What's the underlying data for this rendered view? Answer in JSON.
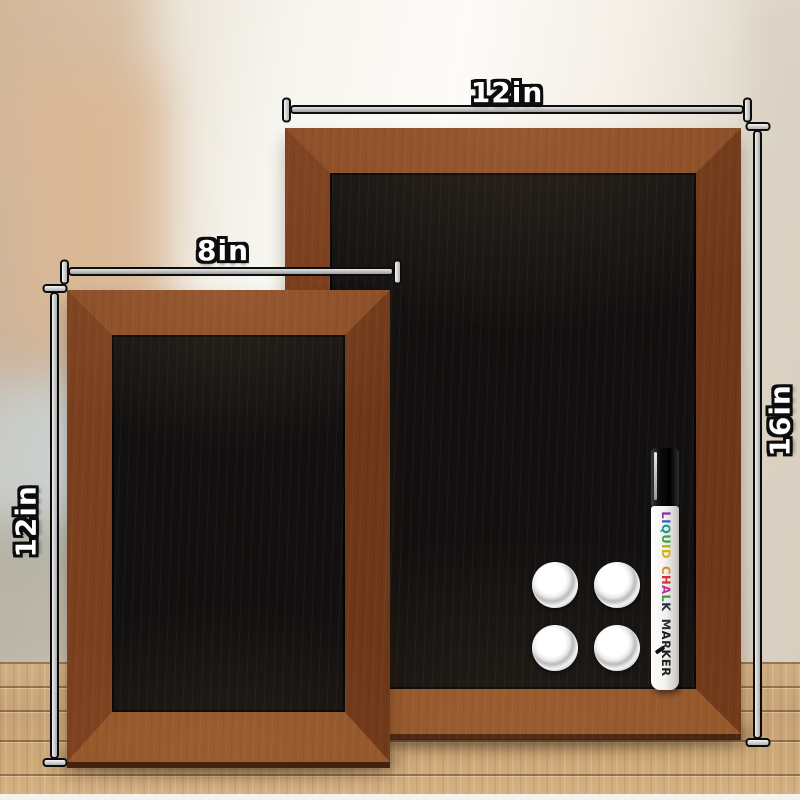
{
  "labels": {
    "large_width": "12in",
    "large_height": "16in",
    "small_width": "8in",
    "small_height": "12in"
  },
  "marker": {
    "words": [
      {
        "text": "LIQUID",
        "letter_colors": [
          "#8b2fa0",
          "#2b55c8",
          "#0f9a8a",
          "#3aa03a",
          "#a0b41e",
          "#d4b414"
        ]
      },
      {
        "text": "CHALK",
        "letter_colors": [
          "#e08818",
          "#d83030",
          "#c03090",
          "#2f9e42",
          "#23303a"
        ]
      },
      {
        "text": "MARKER",
        "letter_colors": [
          "#23303a",
          "#1c1c1c",
          "#202a30",
          "#1c1c1c",
          "#242424",
          "#1c1c1c"
        ]
      }
    ]
  },
  "magnets": {
    "count": 4
  },
  "colors": {
    "frame_brown": "#7b3f1e",
    "frame_brown_light": "#8a4c26",
    "chalkboard_black": "#131110",
    "table_wood": "#cdab7f",
    "dimension_line_fill": "#c4c4c4",
    "label_text": "#ffffff",
    "label_outline": "#0d0d0d",
    "marker_body": "#f3f2ef",
    "marker_cap": "#0d0d0d",
    "magnet_silver": "#d9dadc"
  }
}
